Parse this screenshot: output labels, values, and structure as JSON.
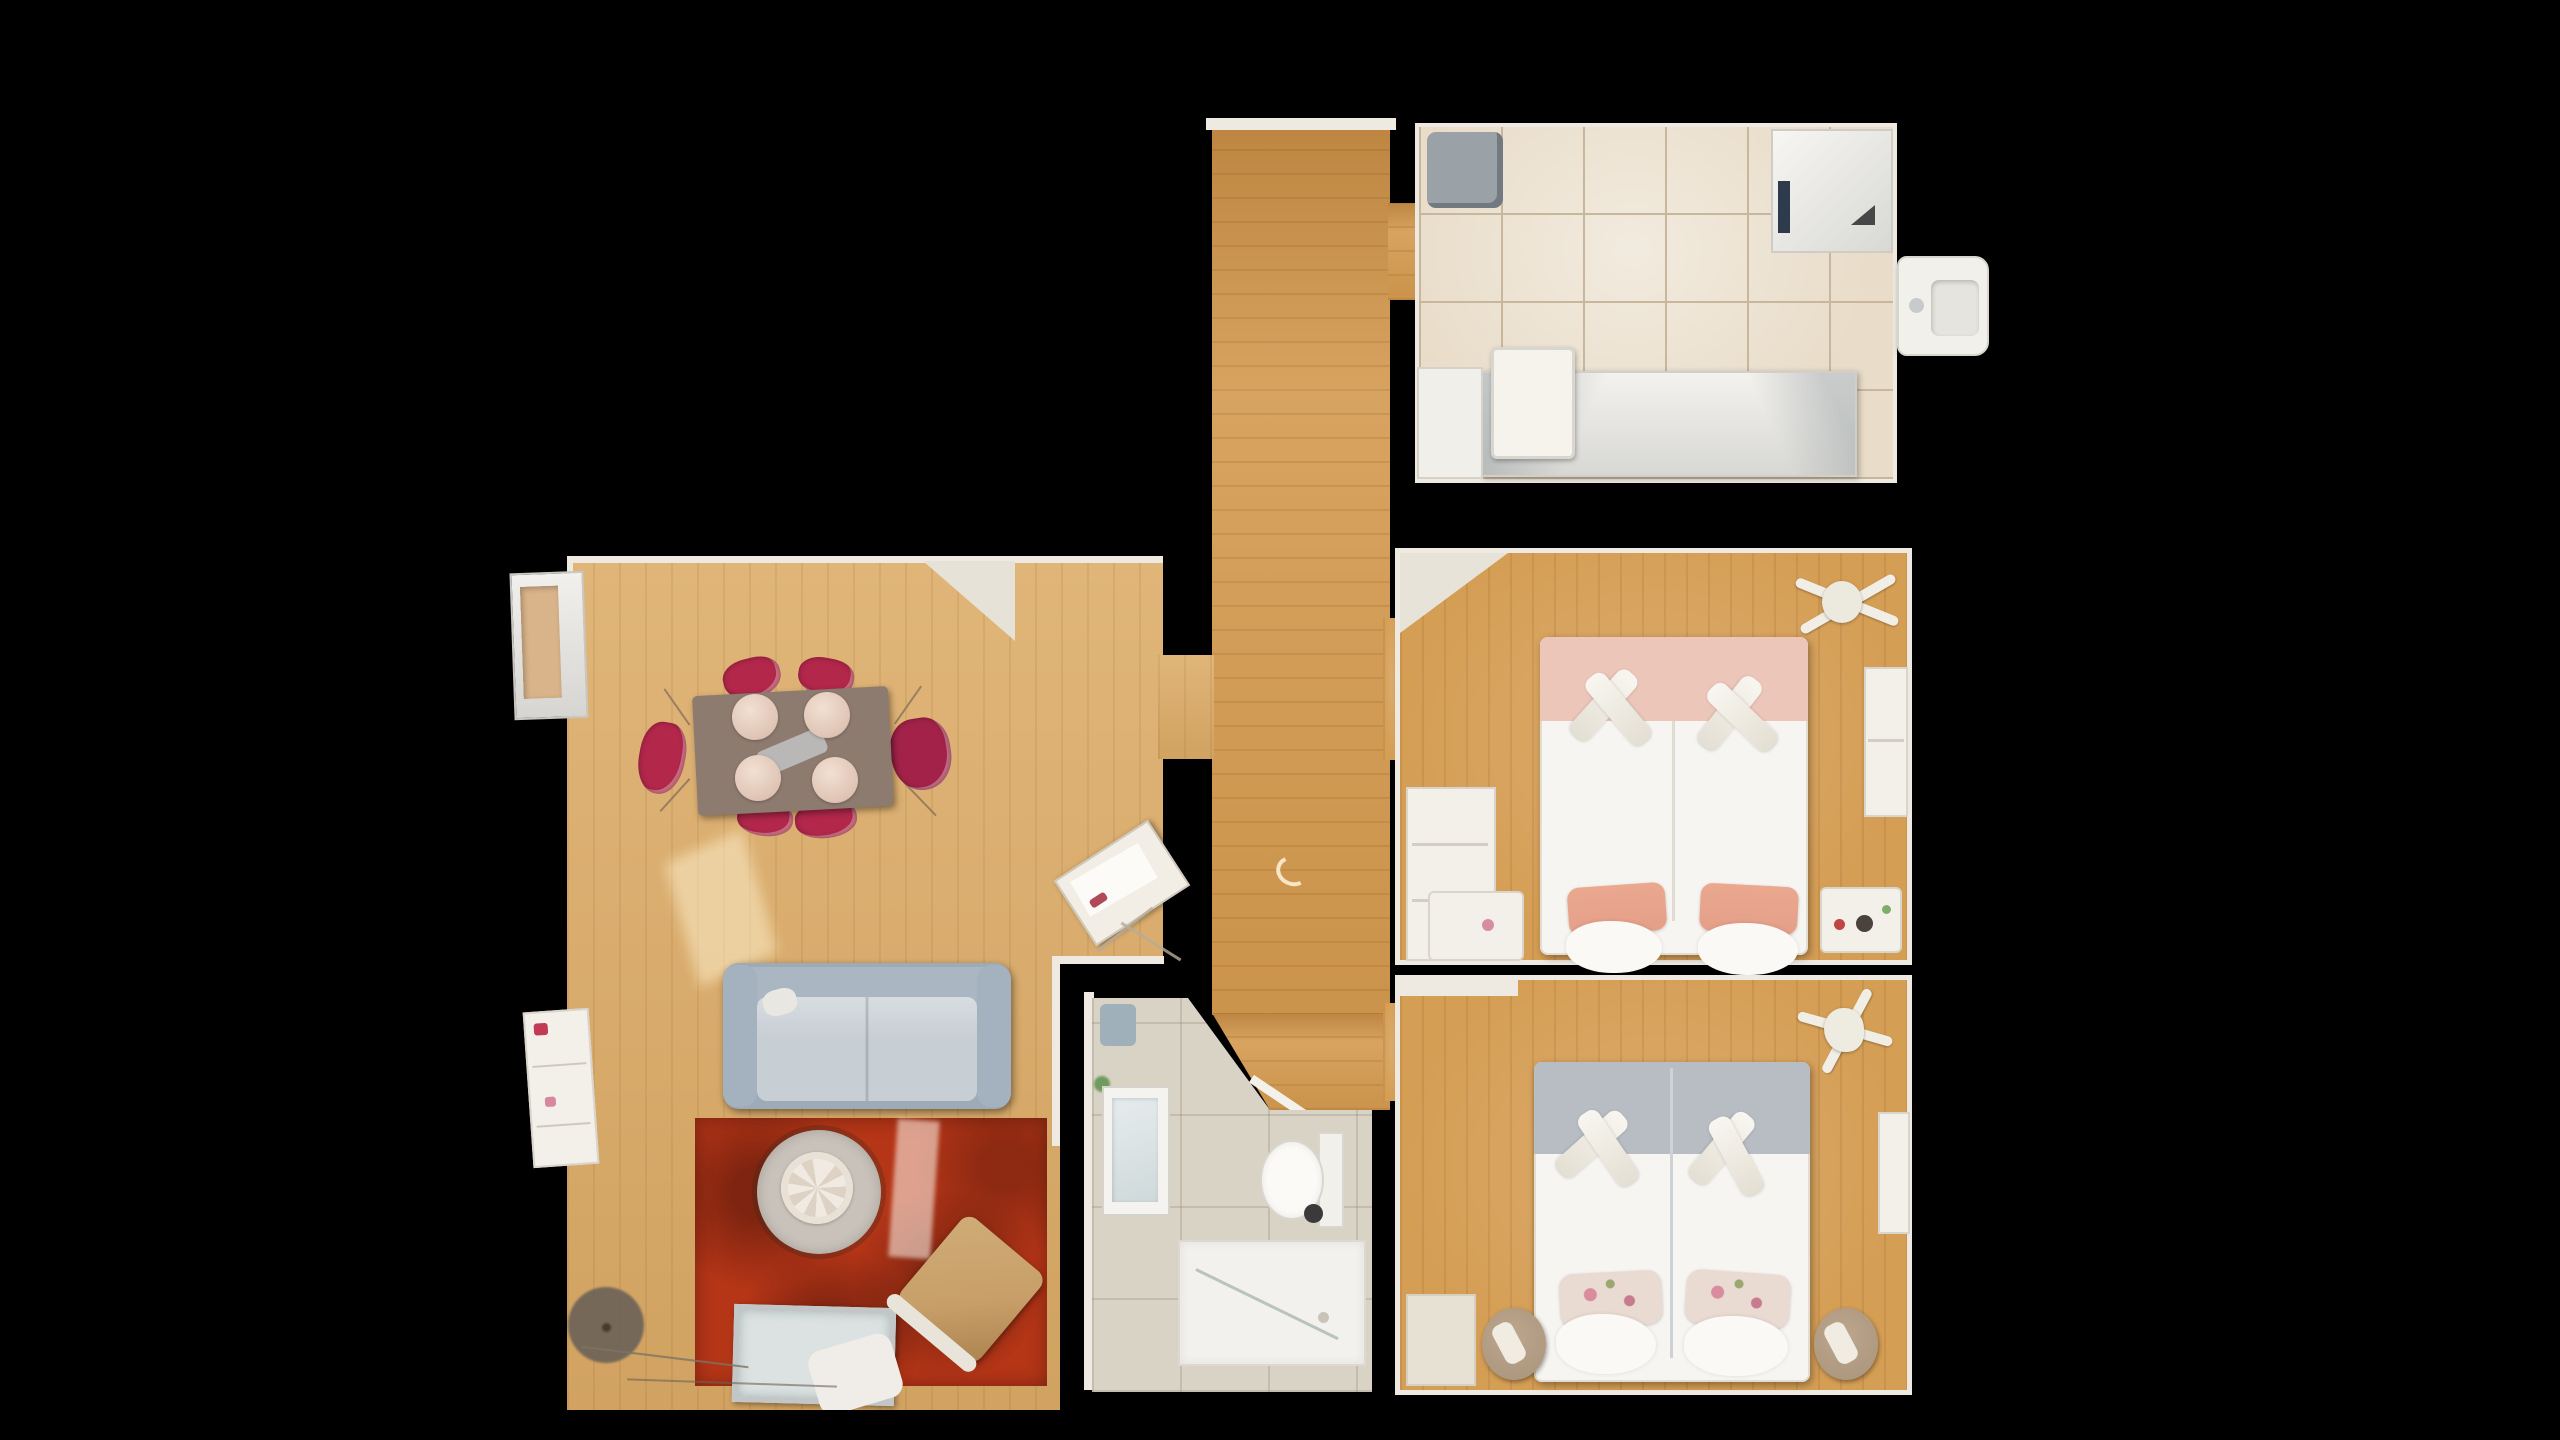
{
  "view": {
    "type": "floorplan-top-down",
    "label": "Top-down 3D dollhouse floor plan of an apartment"
  },
  "colors": {
    "bg": "#000000",
    "wall": "#efeae1",
    "wood-living": "#dcab66",
    "wood-hall": "#d3994e",
    "wood-bed": "#d59e55",
    "tile-kitchen": "#e9ddc9",
    "grout": "#c9b79d",
    "tile-bath": "#d9d3c6",
    "sofa": "#9dabb9",
    "sofa-seat": "#c7ced4",
    "rug": "#b53517",
    "rug-dark": "#7e2410",
    "table-top": "#8e7b70",
    "chair-red": "#b3274b",
    "seat-cream": "#ecd9cc",
    "coffee-table": "#c9c2ba",
    "ornament": "#efe9e1",
    "bed-white": "#f7f5f1",
    "bed1-band": "#edc6ba",
    "bed1-pillow": "#e59f89",
    "bed2-band": "#b7bdc3",
    "bed2-pillow": "#eadbd2",
    "pouf": "#ad9880",
    "lounge": "#c79e67",
    "glass": "#dbe2e1",
    "metal": "#c3c6c6",
    "lamp": "#6e6459",
    "plant": "#6f9b5d",
    "appliance": "#9aa1a7",
    "sun": "#fff3d2"
  },
  "rooms": [
    {
      "id": "living-room",
      "label": "Living room with dining area"
    },
    {
      "id": "hallway",
      "label": "Hallway"
    },
    {
      "id": "kitchen",
      "label": "Kitchen"
    },
    {
      "id": "bedroom-one",
      "label": "Bedroom with pink double bed"
    },
    {
      "id": "bedroom-two",
      "label": "Bedroom with grey double bed"
    },
    {
      "id": "bathroom",
      "label": "Bathroom"
    }
  ],
  "furniture": {
    "living_room": [
      "dining-table",
      "red-dining-chairs",
      "cream-chair-seats",
      "grey-blue-sofa",
      "red-rug",
      "round-coffee-table",
      "white-table-ornament",
      "glass-tv-table",
      "wooden-lounge-chair",
      "floor-lamp-shade",
      "sideboard",
      "low-bookshelf",
      "corner-desk",
      "sunlight-patch",
      "cables"
    ],
    "hallway": [
      "wood-floor",
      "kitchen-doorway",
      "living-room-doorway",
      "bedroom-doorways",
      "bathroom-doorway",
      "floor-scuff-mark"
    ],
    "kitchen": [
      "tiled-floor",
      "grey-appliance",
      "fridge-cabinet",
      "counter-run",
      "island-table",
      "protruding-sink"
    ],
    "bedroom_one": [
      "double-bed",
      "pink-blanket-band",
      "rolled-towels",
      "salmon-pillows",
      "desk-shelf",
      "left-nightstand",
      "right-nightstand",
      "wardrobe",
      "drying-rack",
      "corner-wall-cut"
    ],
    "bedroom_two": [
      "double-bed",
      "grey-blanket-band",
      "rolled-towels",
      "floral-pillows",
      "left-pouf",
      "right-pouf",
      "ceiling-fan",
      "wardrobe",
      "floor-mat",
      "top-shelf"
    ],
    "bathroom": [
      "vanity-sink",
      "mirror",
      "plant",
      "washing-machine",
      "toilet",
      "walk-in-shower",
      "glass-partition"
    ]
  }
}
